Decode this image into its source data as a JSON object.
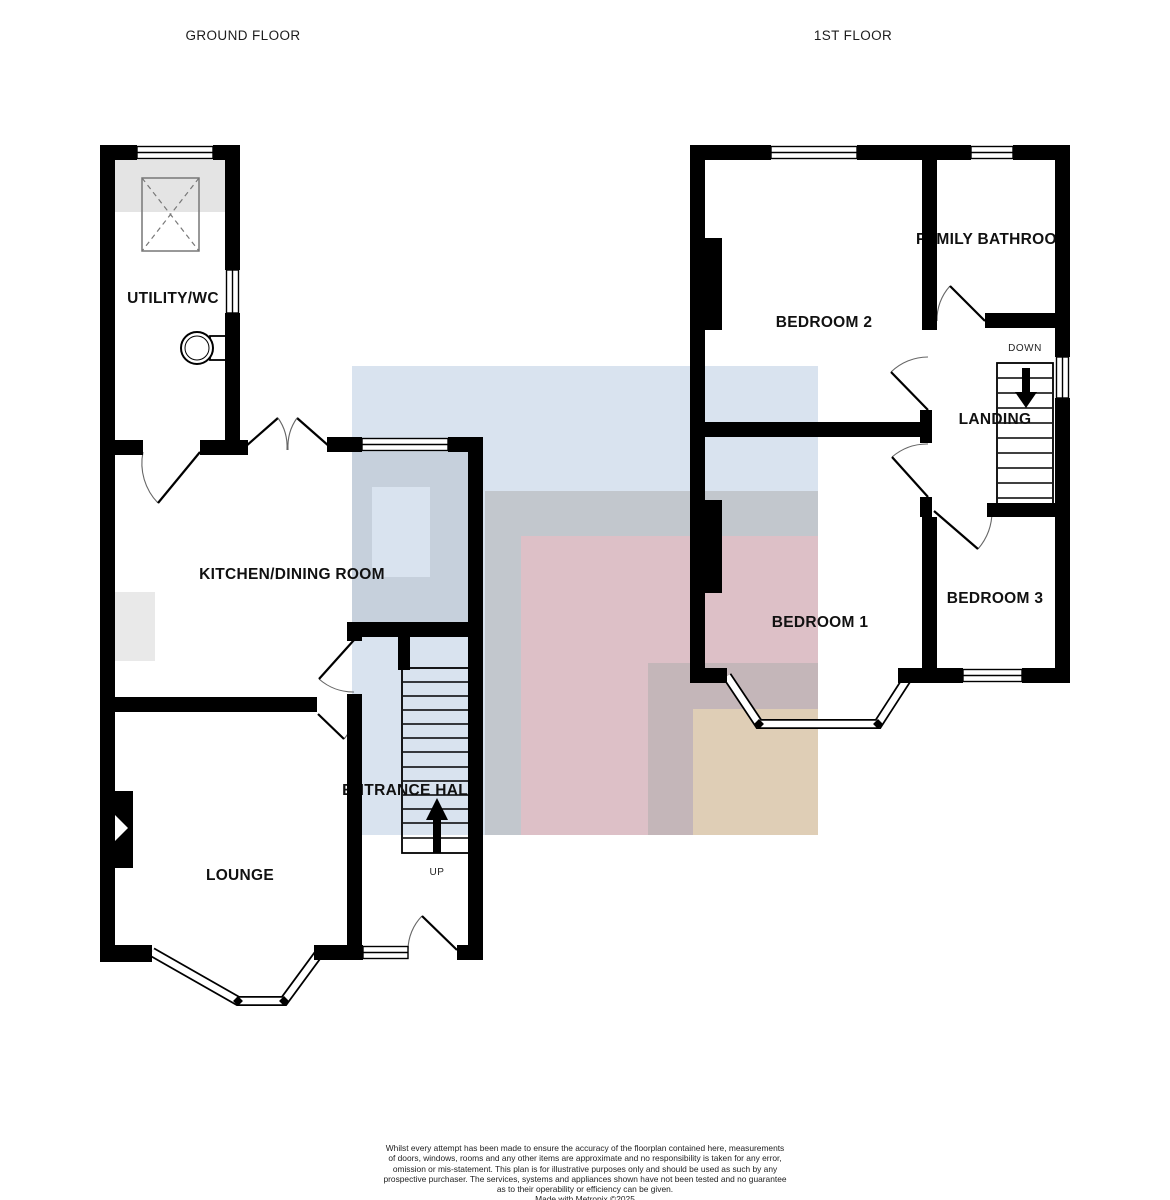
{
  "titles": {
    "ground_floor": "GROUND FLOOR",
    "first_floor": "1ST FLOOR"
  },
  "rooms": {
    "utility": {
      "label": "UTILITY/WC"
    },
    "kitchen": {
      "label": "KITCHEN/DINING ROOM"
    },
    "lounge": {
      "label": "LOUNGE"
    },
    "entrance_hall": {
      "label": "ENTRANCE HALL"
    },
    "bedroom2": {
      "label": "BEDROOM 2"
    },
    "family_bathroom": {
      "label": "FAMILY BATHROOM"
    },
    "landing": {
      "label": "LANDING"
    },
    "bedroom1": {
      "label": "BEDROOM 1"
    },
    "bedroom3": {
      "label": "BEDROOM 3"
    }
  },
  "stairs": {
    "up_label": "UP",
    "down_label": "DOWN"
  },
  "icons": {
    "up_arrow": "arrow-up",
    "down_arrow": "arrow-down"
  },
  "colors": {
    "wall": "#000000",
    "shading_gray": "#e4e4e4",
    "counter_gray": "#d9d9d9",
    "overlay_blue": "#b4c8e0",
    "overlay_gray": "#ababab",
    "overlay_pink": "#f7bac2",
    "overlay_yellow": "#f9e6b4"
  },
  "disclaimer": {
    "lines": [
      "Whilst every attempt has been made to ensure the accuracy of the floorplan contained here, measurements",
      "of doors, windows, rooms and any other items are approximate and no responsibility is taken for any error,",
      "omission or mis-statement. This plan is for illustrative purposes only and should be used as such by any",
      "prospective purchaser. The services, systems and appliances shown have not been tested and no guarantee",
      "as to their operability or efficiency can be given."
    ],
    "credit": "Made with Metropix ©2025"
  }
}
